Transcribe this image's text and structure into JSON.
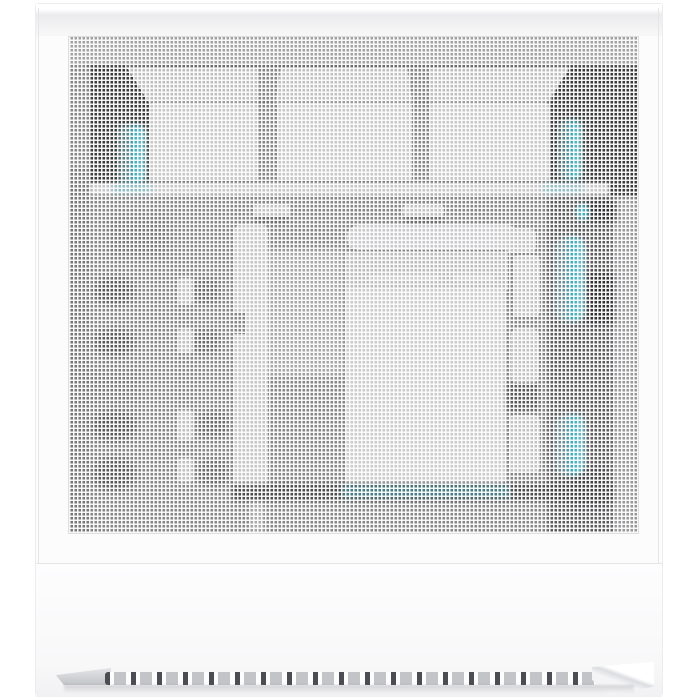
{
  "scene": {
    "type": "product-photo",
    "subject": "White mini-tower PC case, straight-on front view with full perforated mesh front panel",
    "front_panel": "fine square-perforated mesh, white",
    "lower_front": "solid white panel with horizontal vent slot strip near the bottom edge",
    "visible_internals": {
      "top_fan_count": 3,
      "fan_color": "white",
      "accent_cable_color": "cyan",
      "accent_cable_locations": [
        "upper-left corner",
        "upper-right corner",
        "right side middle",
        "right side lower"
      ],
      "center_components": [
        "rounded horizontal bar",
        "radiator band",
        "large white block",
        "white vertical cable-cover column"
      ],
      "shadow_areas": [
        "top-left corner",
        "top-right corner",
        "right interior column",
        "lower horizontal band"
      ]
    },
    "background": "plain white"
  },
  "palette": {
    "bg": "#ffffff",
    "case-white": "#fcfcfd",
    "mesh-base": "#a6a6a6",
    "mesh-line": "#fbfbfc",
    "shadow-dark": "#474747",
    "accent-cyan": "#3fd9ec",
    "vent-dark": "#4b4d52",
    "vent-gray": "#c3c4c7",
    "seam": "#e6e6e8"
  }
}
